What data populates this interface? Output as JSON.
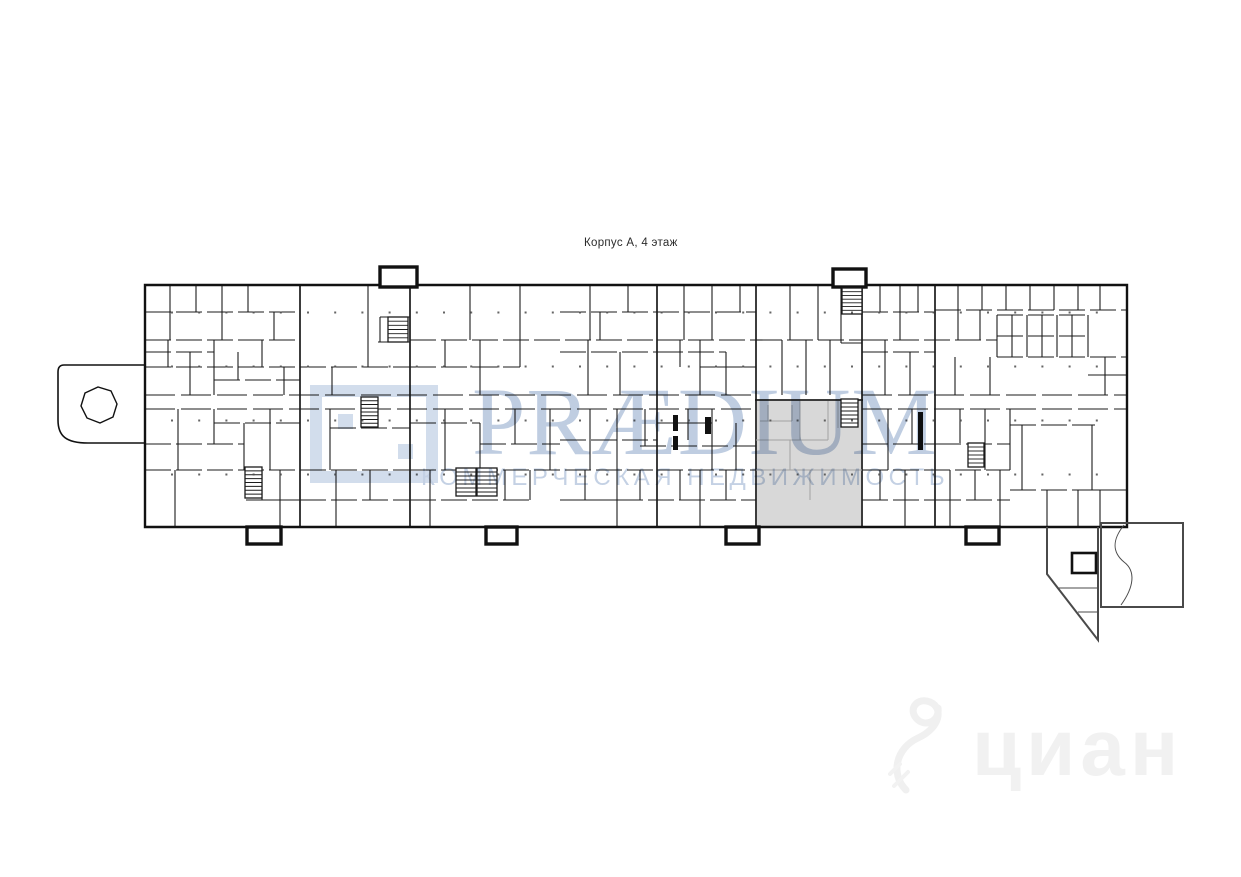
{
  "title": {
    "text": "Корпус А, 4 этаж"
  },
  "watermark": {
    "brand": "PRÆDIUM",
    "tagline": "КОММЕРЧЕСКАЯ НЕДВИЖИМОСТЬ",
    "brand_color": "#7f9cc4",
    "tagline_color": "#8aa3c9",
    "logo_color": "#a6bcda",
    "cian_text": "циан",
    "cian_color": "#f1f1f1"
  },
  "plan": {
    "wall_color": "#1b1b1b",
    "outline_color": "#111111",
    "ext_color": "#4a4a4a",
    "light_color": "#a2a2a2",
    "dot_color": "#4a4a4a",
    "highlight": {
      "x": 756,
      "y": 400,
      "w": 106,
      "h": 127,
      "fill": "#d8d8d8",
      "stroke": "#3c3c3c"
    },
    "outline_paths": [
      {
        "d": "M145,285 H1127 V527 H145 Z",
        "w": 2.4
      },
      {
        "d": "M145,365 H64 Q58,365 58,372 V420 C58,436 66,443 88,443 H145",
        "w": 1.6
      },
      {
        "d": "M117,404 L113,417 L100,423 L87,418 L81,406 L85,393 L98,387 L111,391 Z",
        "w": 1.4
      }
    ],
    "extension_paths": [
      {
        "d": "M1101,523 H1183 V607 H1101 Z",
        "w": 2
      },
      {
        "d": "M1047,527 V574 L1098,640 V527",
        "w": 2
      },
      {
        "d": "M1078,612 H1098",
        "w": 1
      },
      {
        "d": "M1058,588 H1098",
        "w": 1
      },
      {
        "d": "M1124,525 C1112,540 1112,552 1124,562 C1136,571 1134,587 1121,605",
        "w": 1
      }
    ],
    "ext_bold_rect": [
      1072,
      553,
      24,
      20
    ],
    "protrusions": [
      [
        380,
        267,
        37,
        20
      ],
      [
        833,
        269,
        33,
        18
      ],
      [
        247,
        527,
        34,
        17
      ],
      [
        486,
        527,
        31,
        17
      ],
      [
        726,
        527,
        33,
        17
      ],
      [
        966,
        527,
        33,
        17
      ]
    ],
    "majors": [
      [
        300,
        285,
        300,
        527
      ],
      [
        410,
        285,
        410,
        527
      ],
      [
        657,
        285,
        657,
        527
      ],
      [
        935,
        285,
        935,
        527
      ],
      [
        756,
        285,
        756,
        401
      ],
      [
        862,
        285,
        862,
        401
      ]
    ],
    "corridors": [
      [
        145,
        395,
        756,
        395
      ],
      [
        862,
        395,
        1127,
        395
      ],
      [
        145,
        409,
        756,
        409
      ],
      [
        862,
        409,
        1127,
        409
      ]
    ],
    "h_walls": [
      [
        145,
        312,
        300,
        312
      ],
      [
        560,
        312,
        756,
        312
      ],
      [
        862,
        312,
        935,
        312
      ],
      [
        935,
        310,
        1127,
        310
      ],
      [
        997,
        315,
        1088,
        315
      ],
      [
        997,
        336,
        1088,
        336
      ],
      [
        997,
        357,
        1127,
        357
      ],
      [
        145,
        340,
        300,
        340
      ],
      [
        410,
        340,
        657,
        340
      ],
      [
        657,
        340,
        756,
        340
      ],
      [
        756,
        340,
        862,
        340
      ],
      [
        862,
        340,
        997,
        340
      ],
      [
        145,
        352,
        214,
        352
      ],
      [
        560,
        352,
        657,
        352
      ],
      [
        657,
        352,
        726,
        352
      ],
      [
        862,
        352,
        935,
        352
      ],
      [
        145,
        367,
        300,
        367
      ],
      [
        300,
        367,
        410,
        367
      ],
      [
        410,
        367,
        520,
        367
      ],
      [
        700,
        367,
        756,
        367
      ],
      [
        214,
        380,
        300,
        380
      ],
      [
        1088,
        375,
        1127,
        375
      ],
      [
        380,
        317,
        410,
        317
      ],
      [
        378,
        342,
        410,
        342
      ],
      [
        841,
        343,
        862,
        343
      ],
      [
        214,
        423,
        300,
        423
      ],
      [
        410,
        423,
        480,
        423
      ],
      [
        657,
        423,
        712,
        423
      ],
      [
        1010,
        425,
        1095,
        425
      ],
      [
        330,
        428,
        410,
        428
      ],
      [
        145,
        444,
        244,
        444
      ],
      [
        480,
        444,
        560,
        444
      ],
      [
        560,
        440,
        657,
        440
      ],
      [
        640,
        446,
        756,
        446
      ],
      [
        862,
        444,
        935,
        444
      ],
      [
        935,
        444,
        1010,
        444
      ],
      [
        145,
        470,
        410,
        470
      ],
      [
        410,
        470,
        657,
        470
      ],
      [
        657,
        470,
        756,
        470
      ],
      [
        862,
        470,
        1010,
        470
      ],
      [
        1010,
        490,
        1095,
        490
      ],
      [
        1095,
        490,
        1127,
        490
      ],
      [
        246,
        500,
        300,
        500
      ],
      [
        300,
        500,
        410,
        500
      ],
      [
        410,
        500,
        530,
        500
      ],
      [
        560,
        500,
        617,
        500
      ],
      [
        617,
        500,
        756,
        500
      ],
      [
        862,
        500,
        935,
        500
      ],
      [
        935,
        500,
        1010,
        500
      ]
    ],
    "v_walls": [
      [
        170,
        285,
        170,
        340
      ],
      [
        196,
        285,
        196,
        312
      ],
      [
        222,
        285,
        222,
        340
      ],
      [
        248,
        285,
        248,
        312
      ],
      [
        274,
        312,
        274,
        340
      ],
      [
        168,
        340,
        168,
        367
      ],
      [
        190,
        352,
        190,
        395
      ],
      [
        214,
        340,
        214,
        395
      ],
      [
        238,
        352,
        238,
        380
      ],
      [
        262,
        340,
        262,
        367
      ],
      [
        284,
        367,
        284,
        395
      ],
      [
        178,
        409,
        178,
        470
      ],
      [
        214,
        409,
        214,
        444
      ],
      [
        244,
        423,
        244,
        470
      ],
      [
        270,
        409,
        270,
        470
      ],
      [
        175,
        470,
        175,
        527
      ],
      [
        262,
        470,
        262,
        500
      ],
      [
        280,
        470,
        280,
        527
      ],
      [
        368,
        285,
        368,
        367
      ],
      [
        332,
        367,
        332,
        395
      ],
      [
        380,
        317,
        380,
        342
      ],
      [
        330,
        409,
        330,
        470
      ],
      [
        336,
        470,
        336,
        527
      ],
      [
        370,
        470,
        370,
        500
      ],
      [
        470,
        285,
        470,
        340
      ],
      [
        520,
        285,
        520,
        340
      ],
      [
        445,
        340,
        445,
        367
      ],
      [
        480,
        340,
        480,
        395
      ],
      [
        520,
        340,
        520,
        367
      ],
      [
        445,
        409,
        445,
        470
      ],
      [
        480,
        423,
        480,
        470
      ],
      [
        515,
        409,
        515,
        444
      ],
      [
        550,
        409,
        550,
        470
      ],
      [
        430,
        470,
        430,
        527
      ],
      [
        505,
        470,
        505,
        500
      ],
      [
        530,
        470,
        530,
        500
      ],
      [
        590,
        285,
        590,
        340
      ],
      [
        628,
        285,
        628,
        312
      ],
      [
        600,
        312,
        600,
        340
      ],
      [
        588,
        340,
        588,
        395
      ],
      [
        620,
        352,
        620,
        395
      ],
      [
        617,
        409,
        617,
        527
      ],
      [
        590,
        409,
        590,
        470
      ],
      [
        645,
        409,
        645,
        446
      ],
      [
        585,
        470,
        585,
        500
      ],
      [
        640,
        470,
        640,
        500
      ],
      [
        684,
        285,
        684,
        340
      ],
      [
        712,
        285,
        712,
        340
      ],
      [
        740,
        285,
        740,
        312
      ],
      [
        680,
        340,
        680,
        367
      ],
      [
        700,
        340,
        700,
        395
      ],
      [
        726,
        352,
        726,
        395
      ],
      [
        688,
        409,
        688,
        440
      ],
      [
        712,
        409,
        712,
        470
      ],
      [
        736,
        423,
        736,
        470
      ],
      [
        680,
        470,
        680,
        500
      ],
      [
        700,
        470,
        700,
        527
      ],
      [
        726,
        470,
        726,
        500
      ],
      [
        790,
        285,
        790,
        340
      ],
      [
        818,
        285,
        818,
        340
      ],
      [
        782,
        340,
        782,
        395
      ],
      [
        806,
        340,
        806,
        395
      ],
      [
        830,
        340,
        830,
        395
      ],
      [
        841,
        287,
        841,
        343
      ],
      [
        880,
        285,
        880,
        312
      ],
      [
        900,
        285,
        900,
        340
      ],
      [
        918,
        285,
        918,
        312
      ],
      [
        885,
        340,
        885,
        395
      ],
      [
        910,
        352,
        910,
        395
      ],
      [
        888,
        409,
        888,
        470
      ],
      [
        912,
        409,
        912,
        444
      ],
      [
        880,
        470,
        880,
        500
      ],
      [
        905,
        470,
        905,
        527
      ],
      [
        958,
        285,
        958,
        310
      ],
      [
        982,
        285,
        982,
        310
      ],
      [
        1006,
        285,
        1006,
        310
      ],
      [
        1030,
        285,
        1030,
        310
      ],
      [
        1054,
        285,
        1054,
        310
      ],
      [
        1078,
        285,
        1078,
        310
      ],
      [
        1100,
        285,
        1100,
        310
      ],
      [
        997,
        315,
        997,
        357
      ],
      [
        1012,
        315,
        1012,
        357
      ],
      [
        1027,
        315,
        1027,
        357
      ],
      [
        1042,
        315,
        1042,
        357
      ],
      [
        1057,
        315,
        1057,
        357
      ],
      [
        1072,
        315,
        1072,
        357
      ],
      [
        1088,
        315,
        1088,
        357
      ],
      [
        958,
        310,
        958,
        340
      ],
      [
        980,
        310,
        980,
        340
      ],
      [
        955,
        357,
        955,
        395
      ],
      [
        990,
        357,
        990,
        395
      ],
      [
        1105,
        357,
        1105,
        395
      ],
      [
        960,
        409,
        960,
        443
      ],
      [
        985,
        409,
        985,
        470
      ],
      [
        1010,
        409,
        1010,
        470
      ],
      [
        1022,
        425,
        1022,
        490
      ],
      [
        1092,
        425,
        1092,
        490
      ],
      [
        950,
        470,
        950,
        527
      ],
      [
        975,
        470,
        975,
        500
      ],
      [
        1000,
        470,
        1000,
        527
      ],
      [
        1047,
        490,
        1047,
        527
      ],
      [
        1078,
        490,
        1078,
        527
      ],
      [
        1100,
        490,
        1100,
        527
      ]
    ],
    "light_walls": [
      [
        756,
        440,
        828,
        440
      ],
      [
        800,
        401,
        800,
        440
      ],
      [
        828,
        401,
        828,
        440
      ],
      [
        768,
        405,
        768,
        421
      ],
      [
        792,
        405,
        792,
        421
      ],
      [
        760,
        421,
        792,
        421
      ],
      [
        790,
        440,
        790,
        470
      ],
      [
        756,
        470,
        862,
        470
      ],
      [
        810,
        470,
        810,
        500
      ],
      [
        838,
        401,
        838,
        428
      ]
    ],
    "bold_bars": [
      [
        673,
        415,
        5,
        16
      ],
      [
        673,
        436,
        5,
        14
      ],
      [
        705,
        417,
        6,
        17
      ],
      [
        918,
        412,
        5,
        38
      ]
    ],
    "stairs": [
      [
        388,
        317,
        20,
        25
      ],
      [
        361,
        397,
        17,
        30
      ],
      [
        245,
        467,
        17,
        31
      ],
      [
        456,
        468,
        20,
        28
      ],
      [
        477,
        468,
        20,
        28
      ],
      [
        841,
        399,
        17,
        28
      ],
      [
        842,
        288,
        20,
        26
      ],
      [
        968,
        443,
        16,
        24
      ]
    ],
    "dots": {
      "x0": 172,
      "dx": 27.2,
      "nx": 35,
      "rows": [
        312.5,
        366.5,
        420.5,
        474.5
      ],
      "size": 2
    }
  }
}
